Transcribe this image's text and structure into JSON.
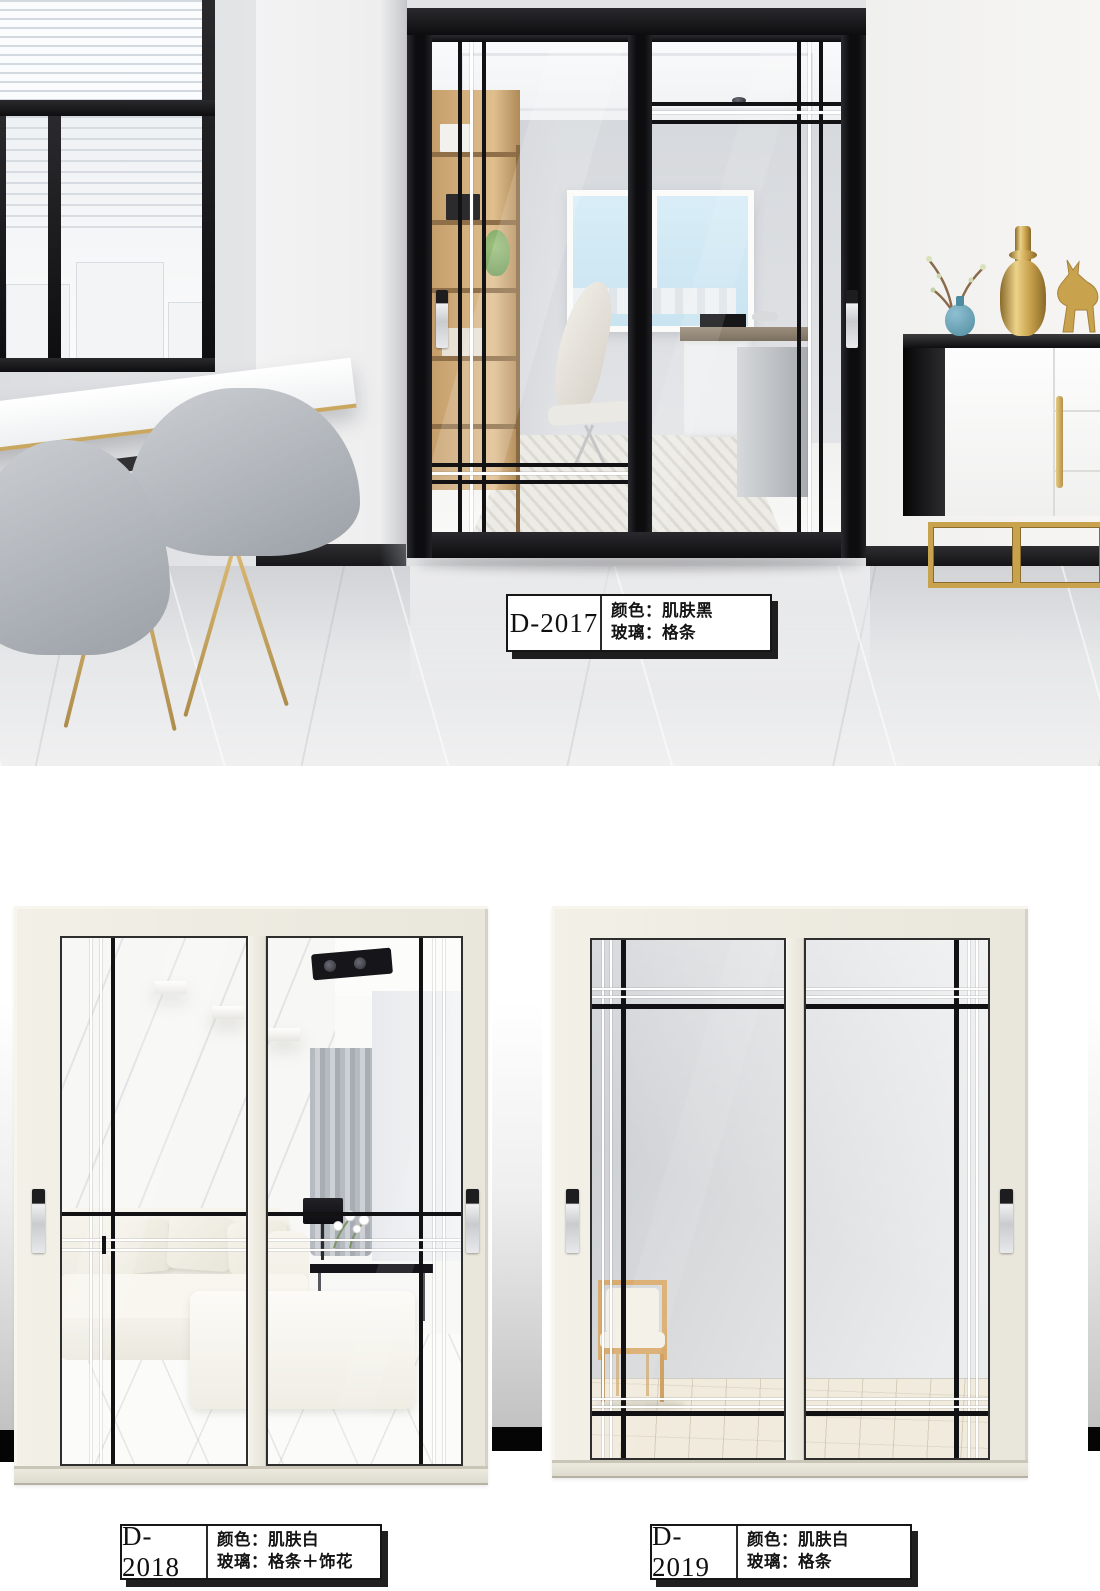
{
  "products": [
    {
      "model": "D-2017",
      "color": "颜色：肌肤黑",
      "glass": "玻璃：格条"
    },
    {
      "model": "D-2018",
      "color": "颜色：肌肤白",
      "glass": "玻璃：格条＋饰花"
    },
    {
      "model": "D-2019",
      "color": "颜色：肌肤白",
      "glass": "玻璃：格条"
    }
  ],
  "palette": {
    "door_black": "#121214",
    "door_skin_white": "#ece9df",
    "grid_line_black": "#121214",
    "grid_line_white": "#ffffff",
    "gold_accent": "#c9a24d",
    "label_border": "#161616",
    "page_background": "#ffffff"
  }
}
